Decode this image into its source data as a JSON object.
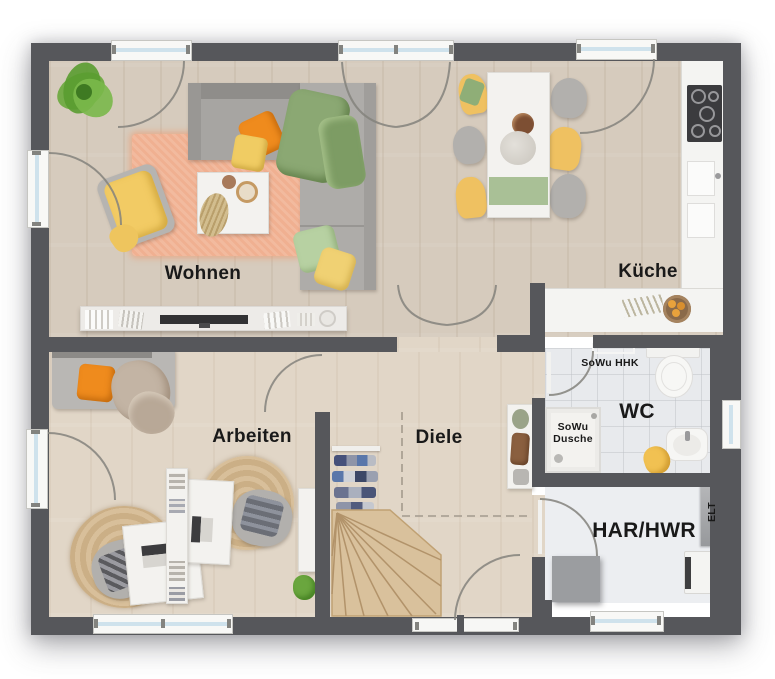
{
  "plan": {
    "rooms": {
      "wohnen": {
        "label": "Wohnen"
      },
      "kueche": {
        "label": "Küche"
      },
      "arbeiten": {
        "label": "Arbeiten"
      },
      "diele": {
        "label": "Diele"
      },
      "wc": {
        "label": "WC"
      },
      "har_hwr": {
        "label": "HAR/HWR"
      }
    },
    "annotations": {
      "sowu_hhk": {
        "label": "SoWu HHK"
      },
      "sowu_dusche": {
        "label": "SoWu Dusche"
      },
      "elt": {
        "label": "ELT"
      }
    },
    "colors": {
      "wall": "#56575b",
      "wood_upper": "#d6cbbd",
      "wood_lower": "#e1d6c7",
      "tile": "#e8eaed",
      "rug_peach": "#f0b091",
      "accent_orange": "#ef8b1d",
      "accent_yellow": "#f0c763",
      "accent_green": "#8ba873",
      "stairs_wood": "#d9c19c",
      "counter_white": "#f4f4f2",
      "cooktop_dark": "#3b3b3e",
      "window_glass": "#cfe2ec"
    }
  }
}
